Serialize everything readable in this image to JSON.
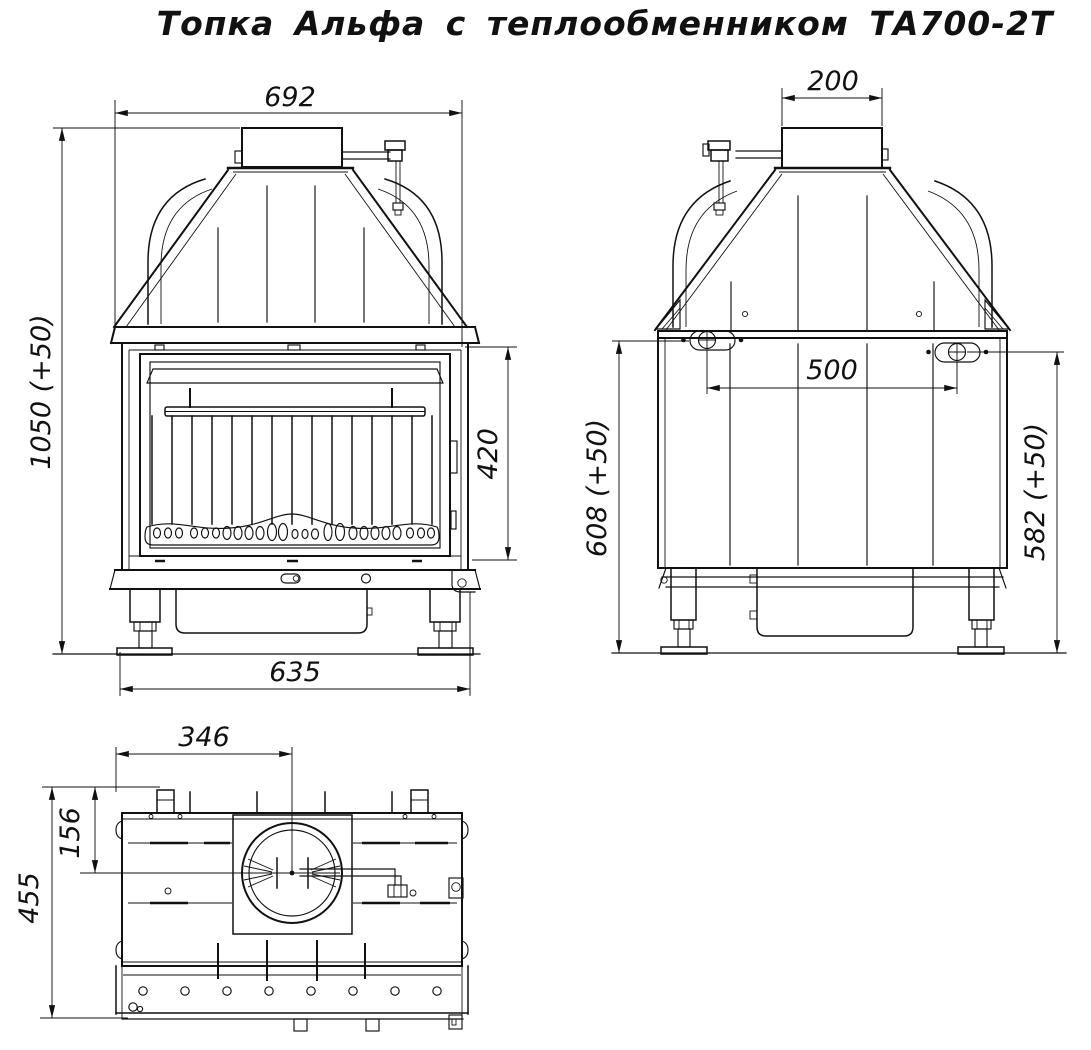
{
  "title": "Топка Альфа с теплообменником ТА700-2Т",
  "colors": {
    "line": "#111111",
    "background": "#ffffff"
  },
  "views": {
    "front": {
      "label": "front-view",
      "dimensions": {
        "overall_width": "692",
        "overall_height": "1050 (+50)",
        "door_height": "420",
        "base_width": "635"
      }
    },
    "rear": {
      "label": "rear-view",
      "dimensions": {
        "flue_collar_width": "200",
        "connector_spacing": "500",
        "height_left": "608 (+50)",
        "height_right": "582 (+50)"
      }
    },
    "top": {
      "label": "top-view",
      "dimensions": {
        "flue_center_from_left": "346",
        "flue_center_from_back": "156",
        "overall_depth": "455"
      }
    }
  }
}
